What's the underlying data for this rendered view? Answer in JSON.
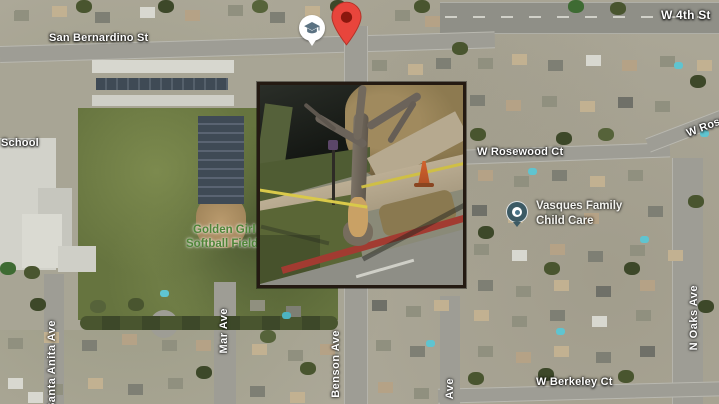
{
  "map": {
    "streets": {
      "san_bernardino": "San Bernardino St",
      "w_4th": "W 4th St",
      "w_rosewood": "W Rosewood Ct",
      "w_rosewood_upper": "W Rosewood Ct",
      "w_berkeley": "W Berkeley Ct",
      "benson": "Benson Ave",
      "santa_anita": "Santa Anita Ave",
      "mar": "Mar Ave",
      "unknown_ave": "Ave",
      "n_oaks": "N Oaks Ave"
    },
    "places": {
      "school": "School",
      "softball_field_line1": "Golden Girl",
      "softball_field_line2": "Softball Field",
      "childcare_line1": "Vasques Family",
      "childcare_line2": "Child Care"
    },
    "icons": {
      "location_marker": "red-location-pin",
      "school_poi": "graduation-cap-pin",
      "childcare_poi": "dot-circle-pin"
    },
    "colors": {
      "marker_red": "#e8453c",
      "marker_red_dark": "#8a170e",
      "school_icon_slate": "#5b7282",
      "childcare_pin": "#3c5a64",
      "park_label_green": "#4f8538",
      "street_label_white": "#ffffff",
      "caution_tape_yellow": "#d9c94a",
      "red_curb": "#a23b31"
    },
    "inset_photo": {
      "alt": "Close-up photo of a tree wrapped with yellow caution tape beside a sidewalk, red curb and traffic cone"
    }
  }
}
